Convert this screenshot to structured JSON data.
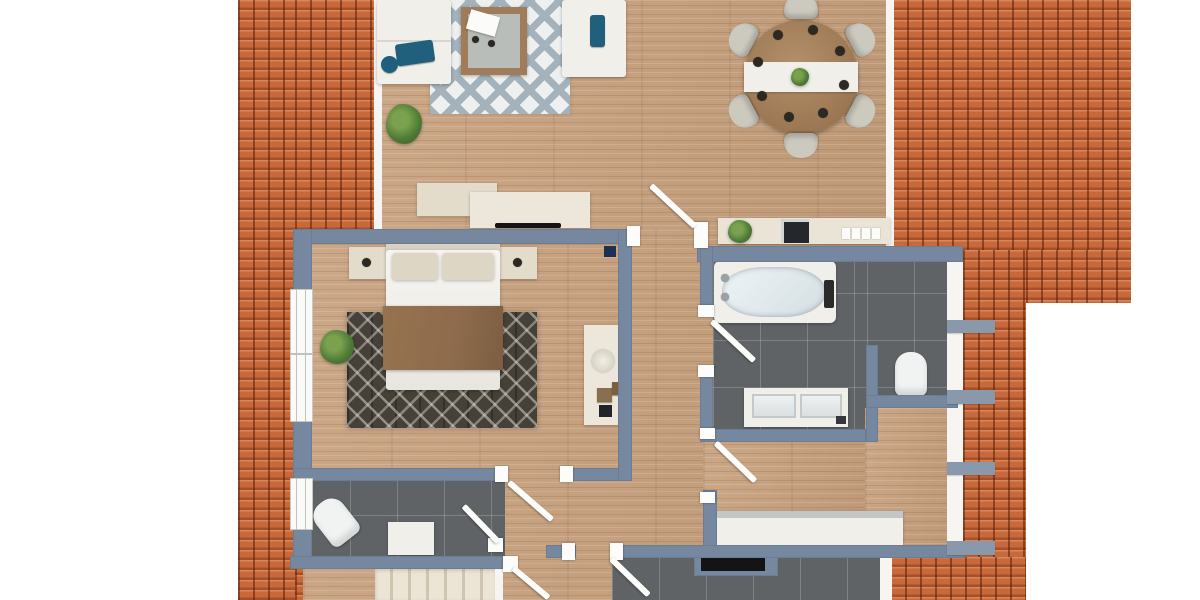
{
  "title": "3D apartment floor plan, top-down view",
  "colors": {
    "roof": "#c8693c",
    "wall": "#76889f",
    "wall_light": "#8a98ac",
    "wood": "#c7a17e",
    "tile": "#5f6366",
    "tile_dark": "#141414",
    "white_furniture": "#f1efe9",
    "cream": "#e3dccb",
    "teal": "#20607c",
    "rug_dark": "#454138",
    "rug_light_base": "#eef0ef",
    "rug_light_line": "#a3b2bb",
    "chair": "#ccc9bf",
    "bed_blanket": "#8d6b4c",
    "table_wood": "#a07c58",
    "plant_green": "#4e7a35",
    "switch_navy": "#1d2f52"
  },
  "rooms": [
    {
      "name": "living-room"
    },
    {
      "name": "dining-area"
    },
    {
      "name": "bedroom"
    },
    {
      "name": "bathroom"
    },
    {
      "name": "toilet-nook"
    },
    {
      "name": "wc"
    },
    {
      "name": "bedroom-2"
    },
    {
      "name": "hallway"
    },
    {
      "name": "utility-room"
    },
    {
      "name": "staircase"
    }
  ],
  "furniture": [
    "corner-sofa",
    "living-rug",
    "coffee-table",
    "tv-sideboard",
    "round-dining-table",
    "dining-chairs-x6",
    "table-runner",
    "place-settings-x8",
    "console-table",
    "double-bed",
    "nightstand-x2",
    "bedroom-rug",
    "desk",
    "bathtub",
    "double-vanity",
    "toilet",
    "wc-toilet",
    "wc-cabinet",
    "wardrobe",
    "kitchen-counter",
    "potted-plant-x3",
    "stairs"
  ]
}
